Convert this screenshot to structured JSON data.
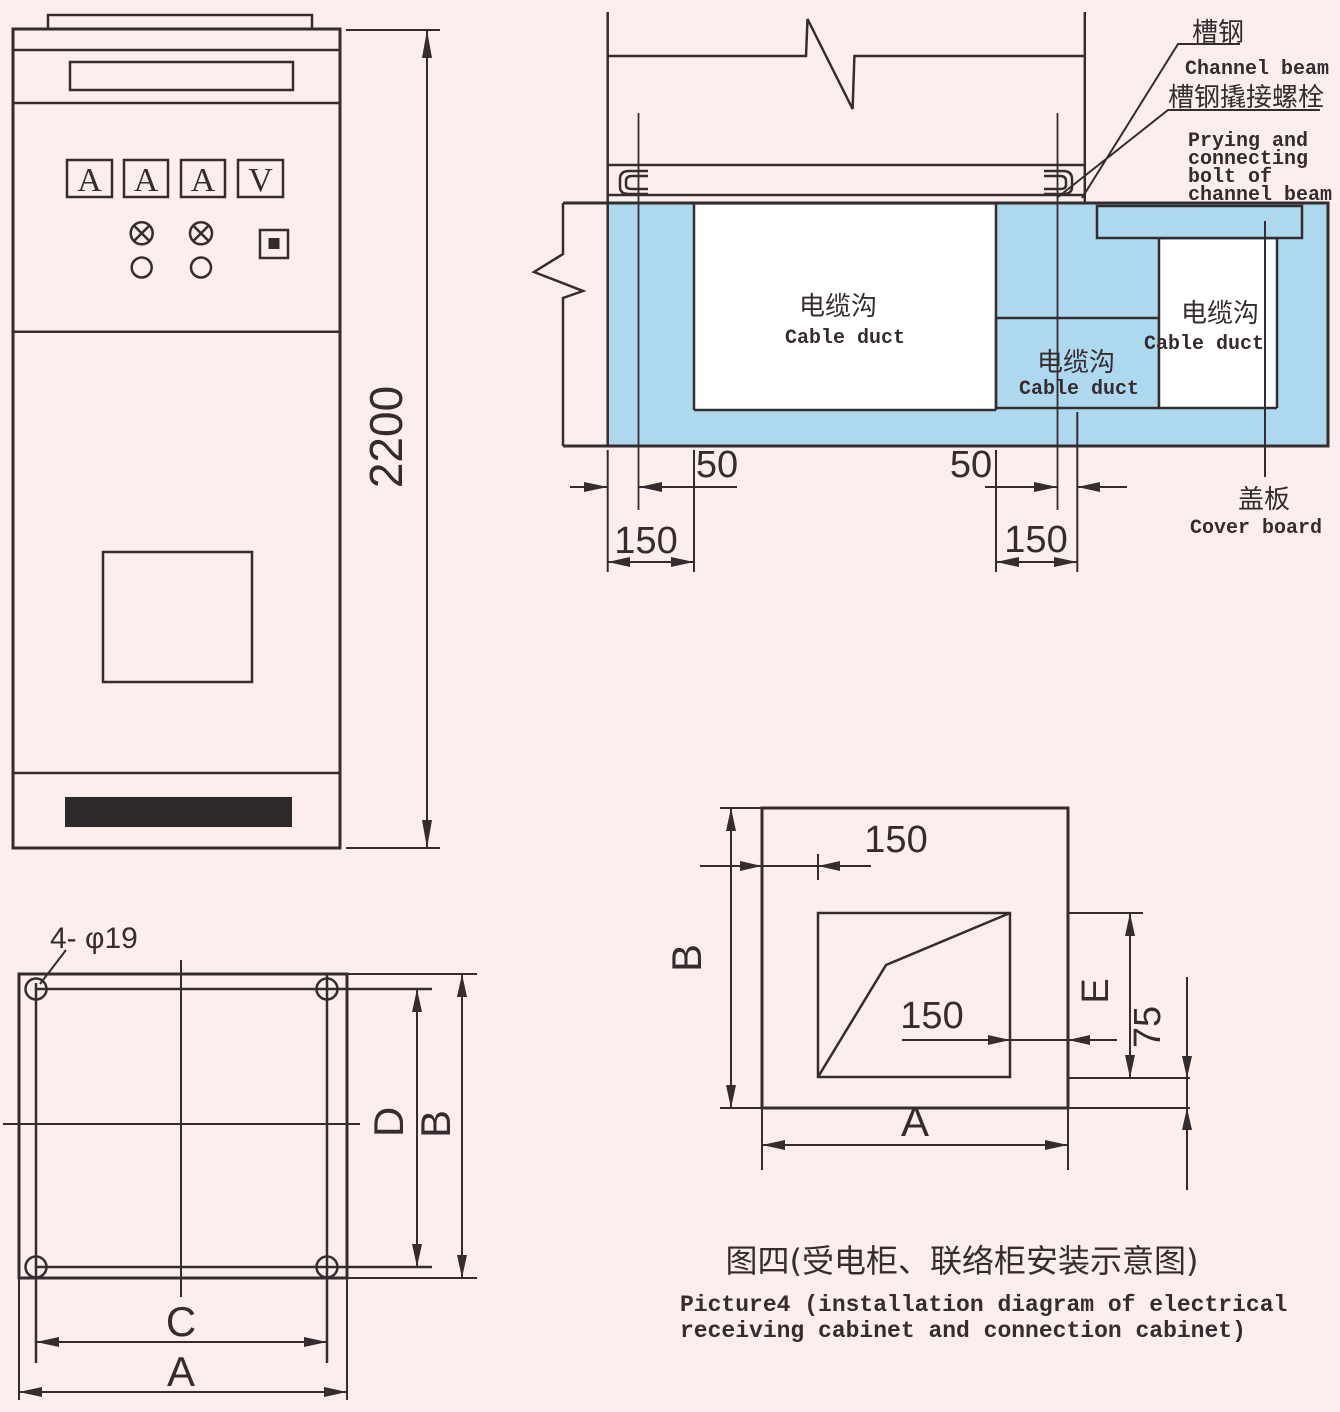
{
  "colors": {
    "background": "#fbeeec",
    "line_color": "#352c30",
    "duct_blue": "#aed8ee",
    "cover_yellow": "#f8e800",
    "vent_black": "#2e282a",
    "duct_white": "#ffffff"
  },
  "front_view": {
    "meter_labels": [
      "A",
      "A",
      "A",
      "V"
    ],
    "height_dim": "2200"
  },
  "cross_section": {
    "channel_beam_label_cn": "槽钢",
    "channel_beam_label_en": "Channel beam",
    "bolt_label_cn": "槽钢撬接螺栓",
    "bolt_label_en": [
      "Prying and",
      "connecting",
      "bolt of",
      "channel beam"
    ],
    "cover_board_label_cn": "盖板",
    "cover_board_label_en": "Cover board",
    "left_duct_label_cn": "电缆沟",
    "left_duct_label_en": "Cable duct",
    "middle_duct_label_cn": "电缆沟",
    "middle_duct_label_en": "Cable duct",
    "right_duct_label_cn": "电缆沟",
    "right_duct_label_en": "Cable duct",
    "dim_left_offset": "50",
    "dim_left_width": "150",
    "dim_right_offset": "50",
    "dim_right_width": "150"
  },
  "foundation_plan": {
    "holes_label": "4- φ19",
    "dim_inner_width": "C",
    "dim_outer_width": "A",
    "dim_inner_depth": "D",
    "dim_outer_depth": "B"
  },
  "opening_plan": {
    "dim_top_offset": "150",
    "dim_right_offset": "150",
    "dim_depth": "B",
    "dim_width": "A",
    "dim_opening_depth": "E",
    "dim_margin": "75"
  },
  "caption": {
    "line_cn": "图四(受电柜、联络柜安装示意图)",
    "line_en_1": "Picture4 (installation diagram of electrical",
    "line_en_2": "receiving cabinet and connection cabinet)"
  }
}
